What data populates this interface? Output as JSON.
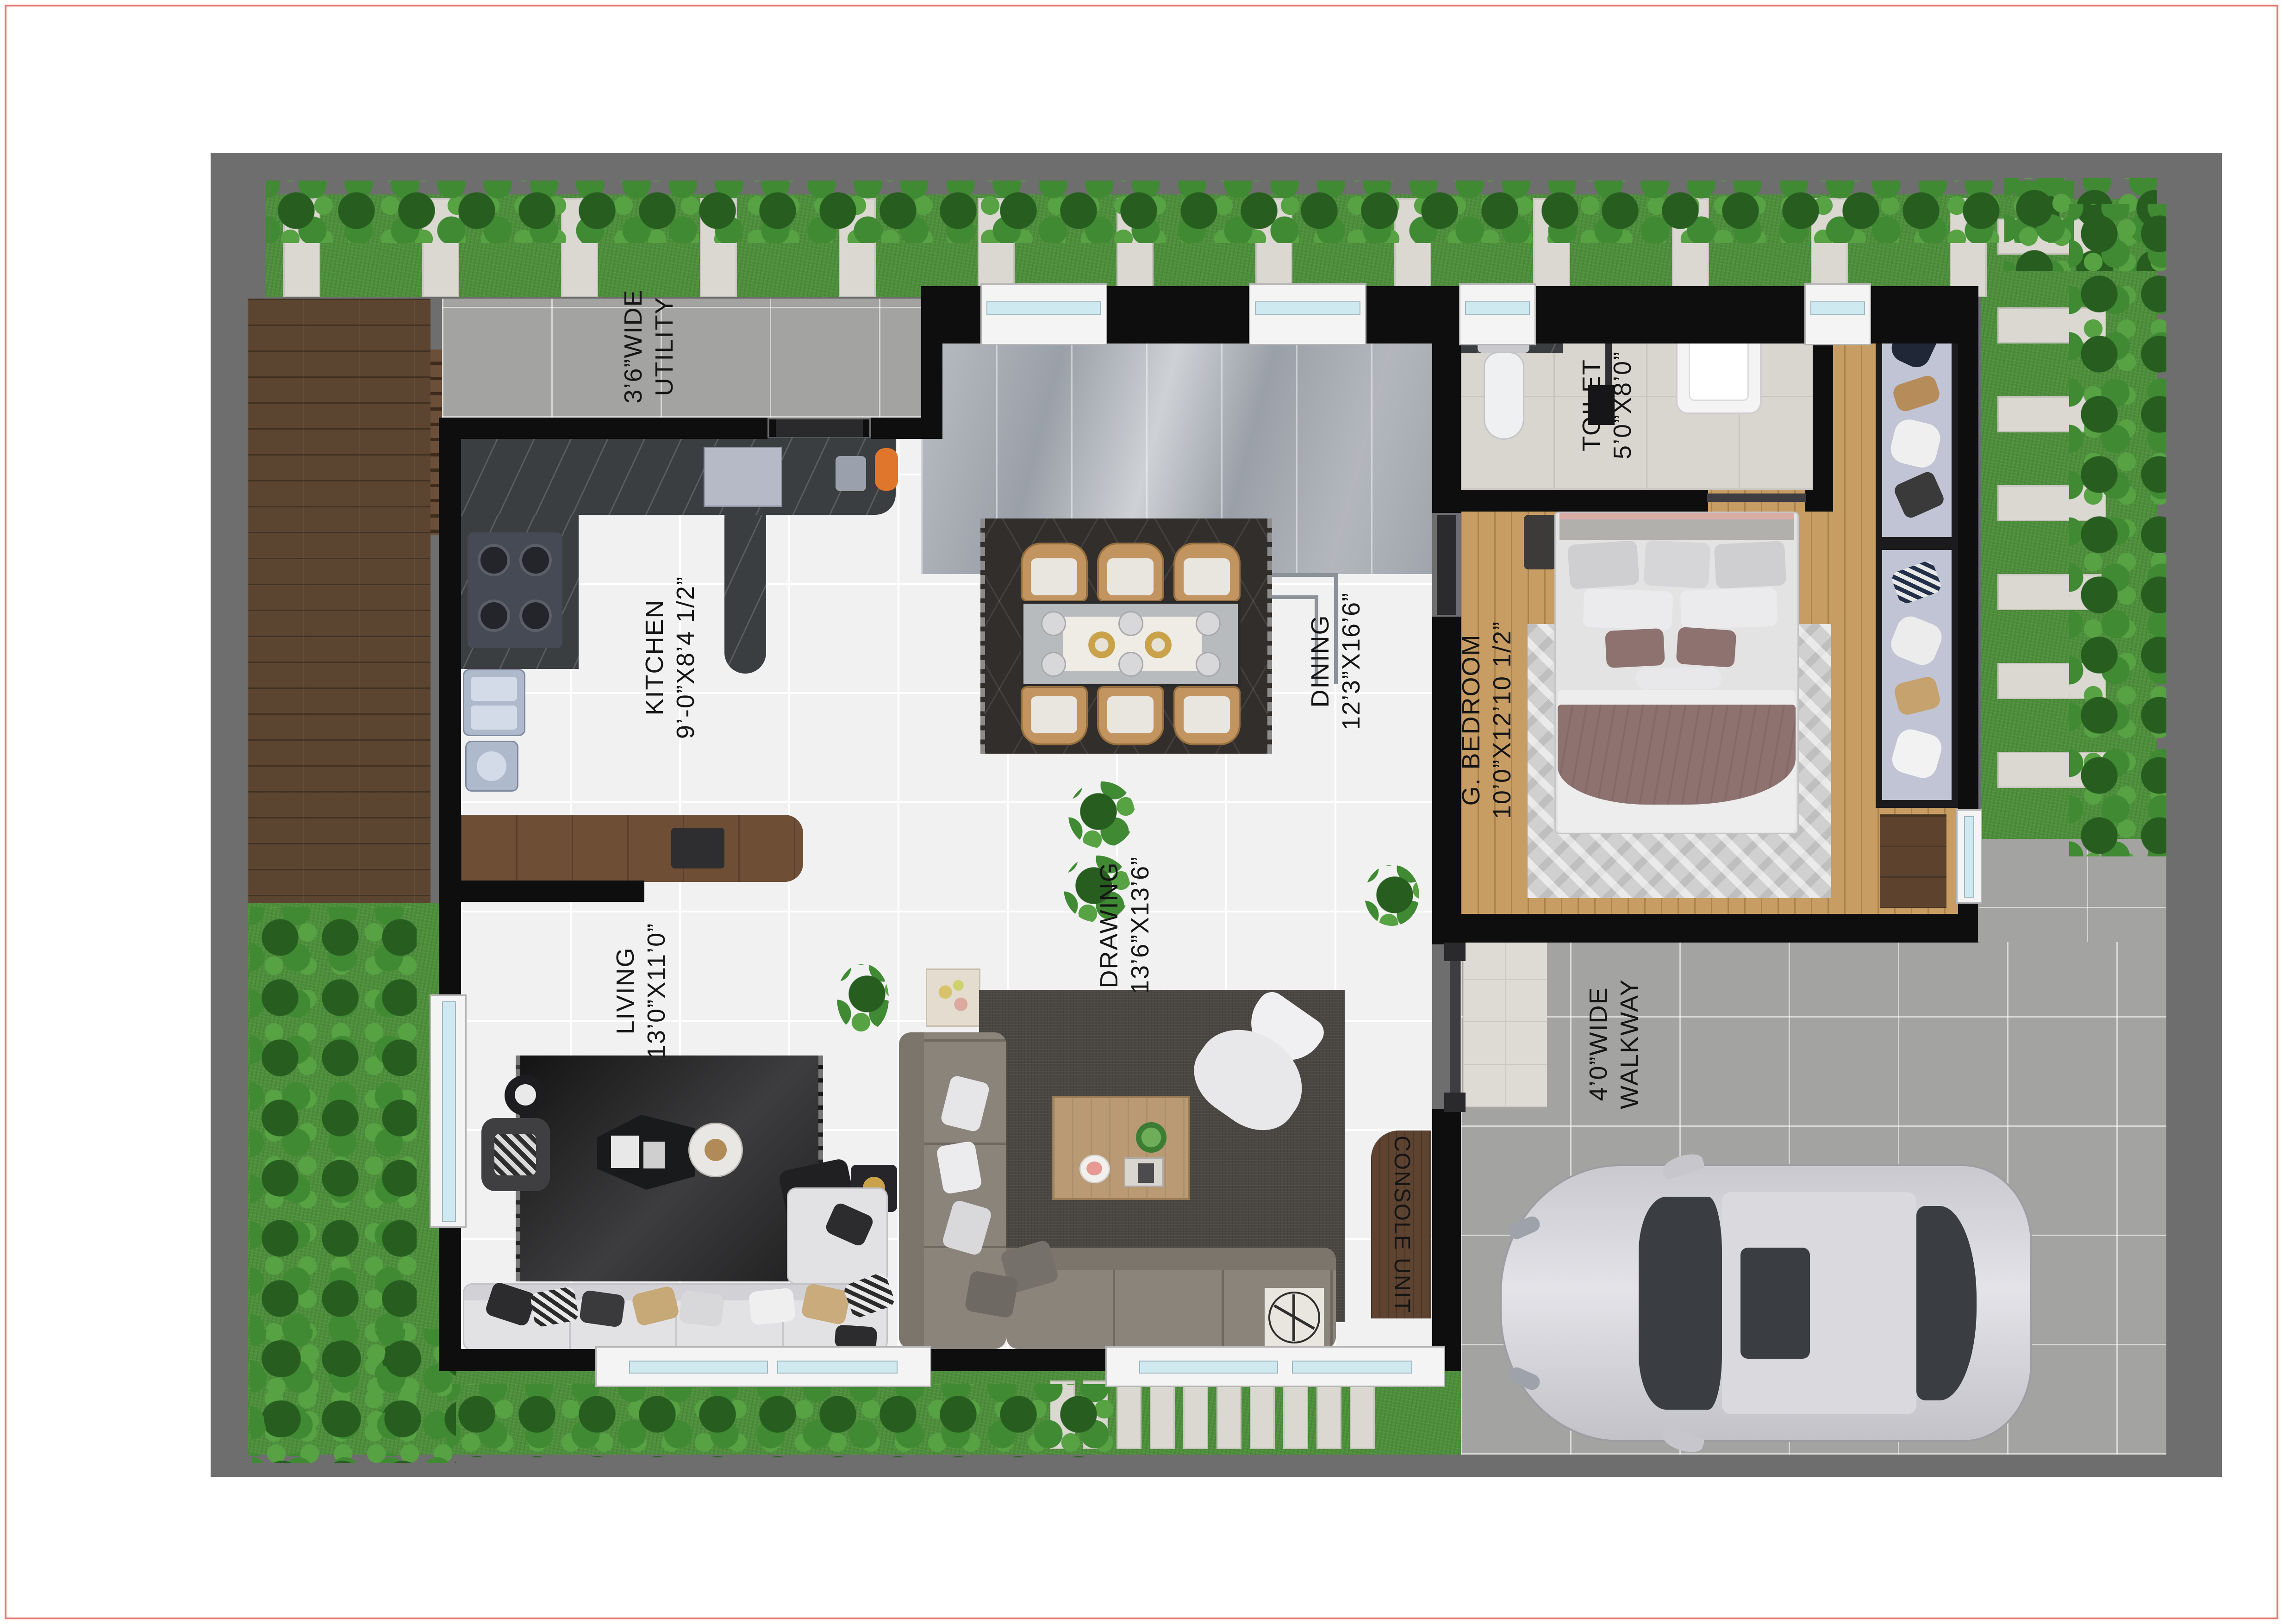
{
  "labels": {
    "utility1": "3’6”WIDE",
    "utility2": "UTILITY",
    "kitchen1": "KITCHEN",
    "kitchen2": "9’-0”X8’4 1/2”",
    "dining1": "DINING",
    "dining2": "12’3”X16’6”",
    "toilet1": "TOILET",
    "toilet2": "5’0”X8’0”",
    "bedroom1": "G. BEDROOM",
    "bedroom2": "10’0”X12’10 1/2”",
    "drawing1": "DRAWING",
    "drawing2": "13’6”X13’6”",
    "living1": "LIVING",
    "living2": "13’0”X11’0”",
    "walkway1": "4’0”WIDE",
    "walkway2": "WALKWAY",
    "console": "CONSOLE UNIT"
  },
  "palette": {
    "page_border": "#e4766d",
    "site_gray": "#6e6e6e",
    "grass": "#4d8f3b",
    "wall_black": "#0e0e0e",
    "deck_wood": "#5b4531",
    "bedroom_wood": "#c79d64",
    "white_marble": "#f1f1f2",
    "gray_marble": "#a5aab1",
    "counter_marble": "#3b3e41",
    "console_wood": "#5d4330",
    "dining_chair": "#c2945f",
    "blanket_mauve": "#8d7270",
    "car_body": "#d6d6dc"
  }
}
